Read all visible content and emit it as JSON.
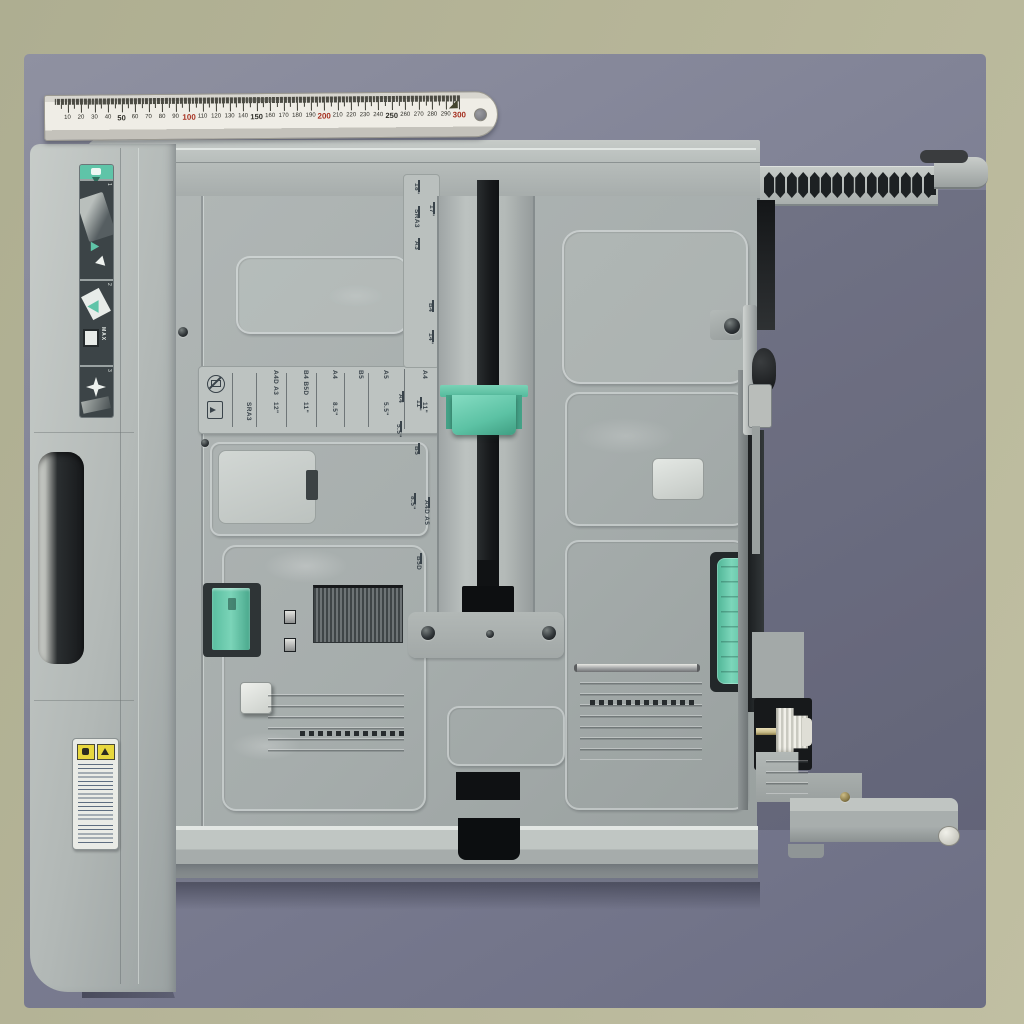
{
  "photo": {
    "alt": "Light gray printer paper cassette tray photographed from above on a blue-gray mat, with a 300 mm steel ruler laid across the top edge"
  },
  "colors": {
    "table": "#b4b396",
    "mat": "#828496",
    "mat_dark": "#6b6d82",
    "tray": "#b3b9b7",
    "tray_light": "#cdd2cf",
    "tray_dark": "#8f9596",
    "floor": "#a8afae",
    "teal": "#62c8a9",
    "teal_light": "#85dcc2",
    "slot_black": "#17191b",
    "label_bg": "#bdc3c1",
    "marking_text": "#39434a",
    "ruler_face": "#efede6",
    "ruler_red": "#a52f1f",
    "warning_yellow": "#e8d83e"
  },
  "ruler": {
    "unit": "mm",
    "min": 10,
    "max": 300,
    "step": 10,
    "red_numbers": [
      100,
      200,
      300
    ],
    "bold_numbers": [
      50,
      150,
      250
    ]
  },
  "size_scale": {
    "cells": [
      {
        "top": "",
        "bottom": "SRA3"
      },
      {
        "top": "A4D A3",
        "bottom": "12\""
      },
      {
        "top": "B4 B5D",
        "bottom": "11\""
      },
      {
        "top": "A4",
        "bottom": "8.5\""
      },
      {
        "top": "B5",
        "bottom": ""
      },
      {
        "top": "A5",
        "bottom": "5.5\""
      },
      {
        "top": "A4",
        "bottom": "11\""
      }
    ],
    "icons": [
      "no-envelope-icon",
      "load-paper-icon"
    ]
  },
  "length_scale_top": {
    "labels": [
      "18\"",
      "17\"",
      "SRA3",
      "A3",
      "B4",
      "14\""
    ]
  },
  "length_scale_center": {
    "labels": [
      "A4",
      "11\"",
      "5.5\"",
      "B5",
      "8.5\"",
      "A4D A5",
      "B5D"
    ]
  },
  "instruction_label": {
    "steps": [
      "1",
      "2",
      "3"
    ],
    "max_text": "MAX"
  },
  "warning_label": {
    "warning_icon": "warning-triangle"
  }
}
